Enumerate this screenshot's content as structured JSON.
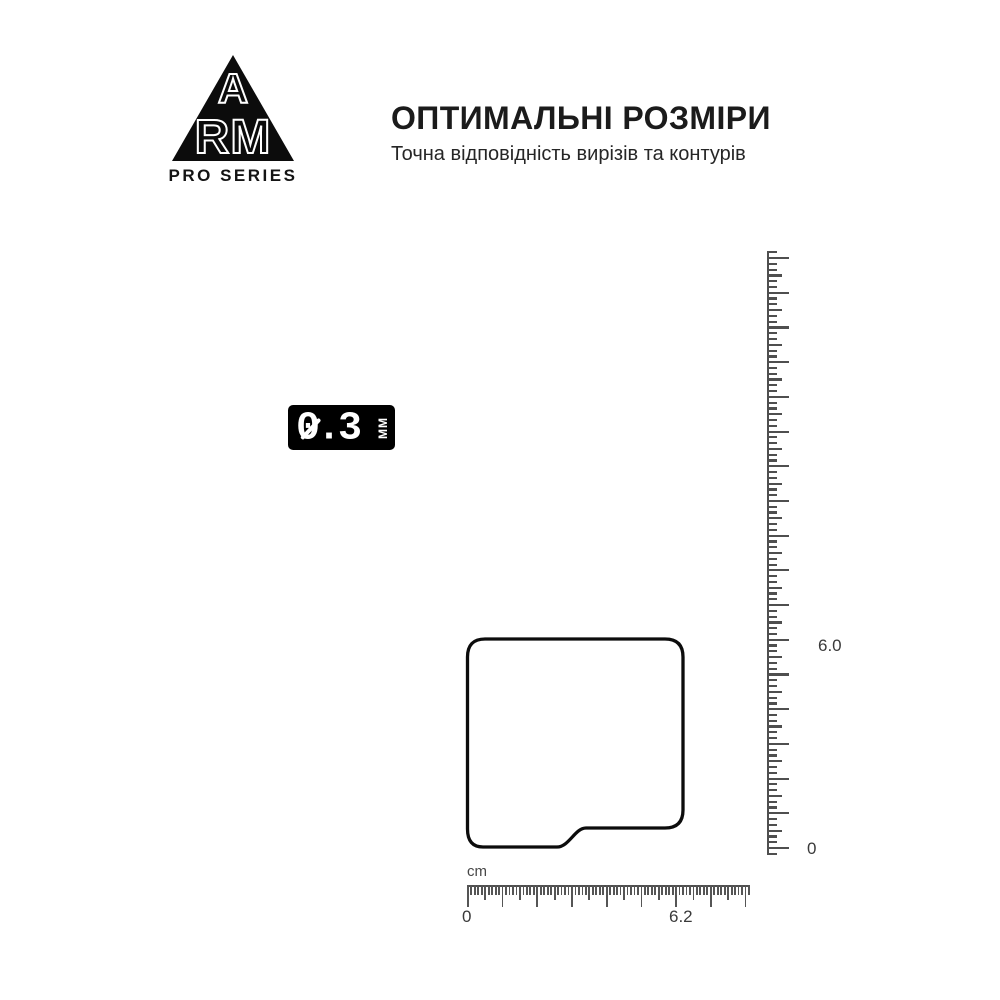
{
  "brand": {
    "letter_top": "A",
    "letters_bottom": "RM",
    "series": "PRO SERIES"
  },
  "header": {
    "title": "ОПТИМАЛЬНІ РОЗМІРИ",
    "subtitle": "Точна відповідність вирізів та контурів"
  },
  "thickness_badge": {
    "value": "0.3",
    "unit": "ММ"
  },
  "rulers": {
    "vertical": {
      "label_top": "6.0",
      "label_bottom": "0"
    },
    "horizontal": {
      "unit": "cm",
      "label_start": "0",
      "label_end": "6.2"
    }
  },
  "colors": {
    "background": "#ffffff",
    "ink": "#0c0c0c",
    "ruler": "#4f4f4f",
    "badge_bg": "#000000",
    "badge_text": "#ffffff"
  }
}
